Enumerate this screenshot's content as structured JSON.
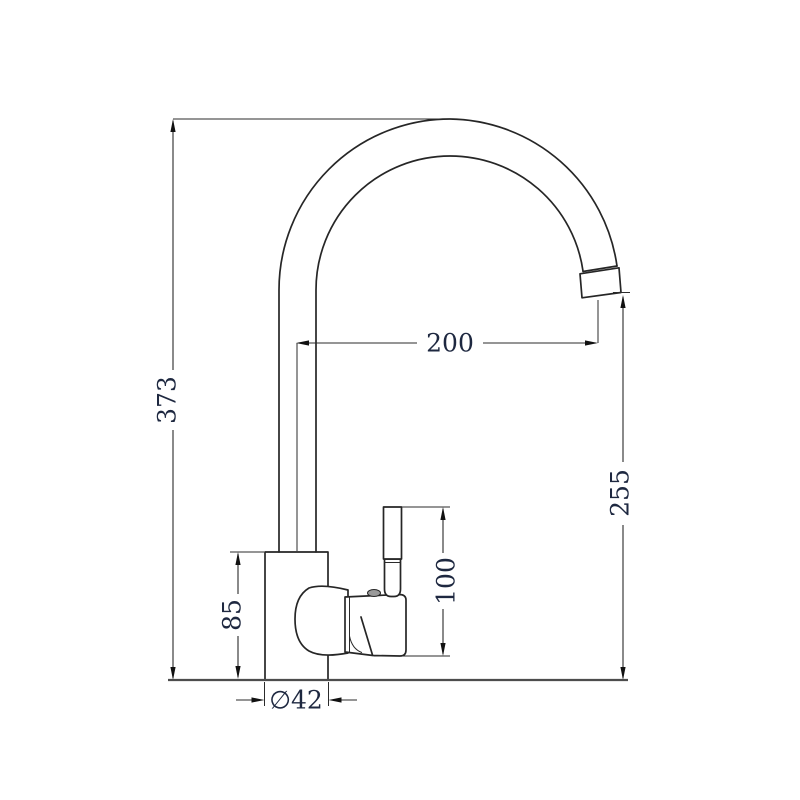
{
  "drawing": {
    "type": "technical-dimension-drawing",
    "subject": "gooseneck kitchen faucet side elevation",
    "units_shown": "mm",
    "background": "#ffffff",
    "line_color": "#262626",
    "text_color": "#1e2840",
    "dims": {
      "overall_height": "373",
      "spout_reach": "200",
      "outlet_height": "255",
      "handle_height": "100",
      "body_height": "85",
      "base_diameter": "∅42"
    }
  }
}
